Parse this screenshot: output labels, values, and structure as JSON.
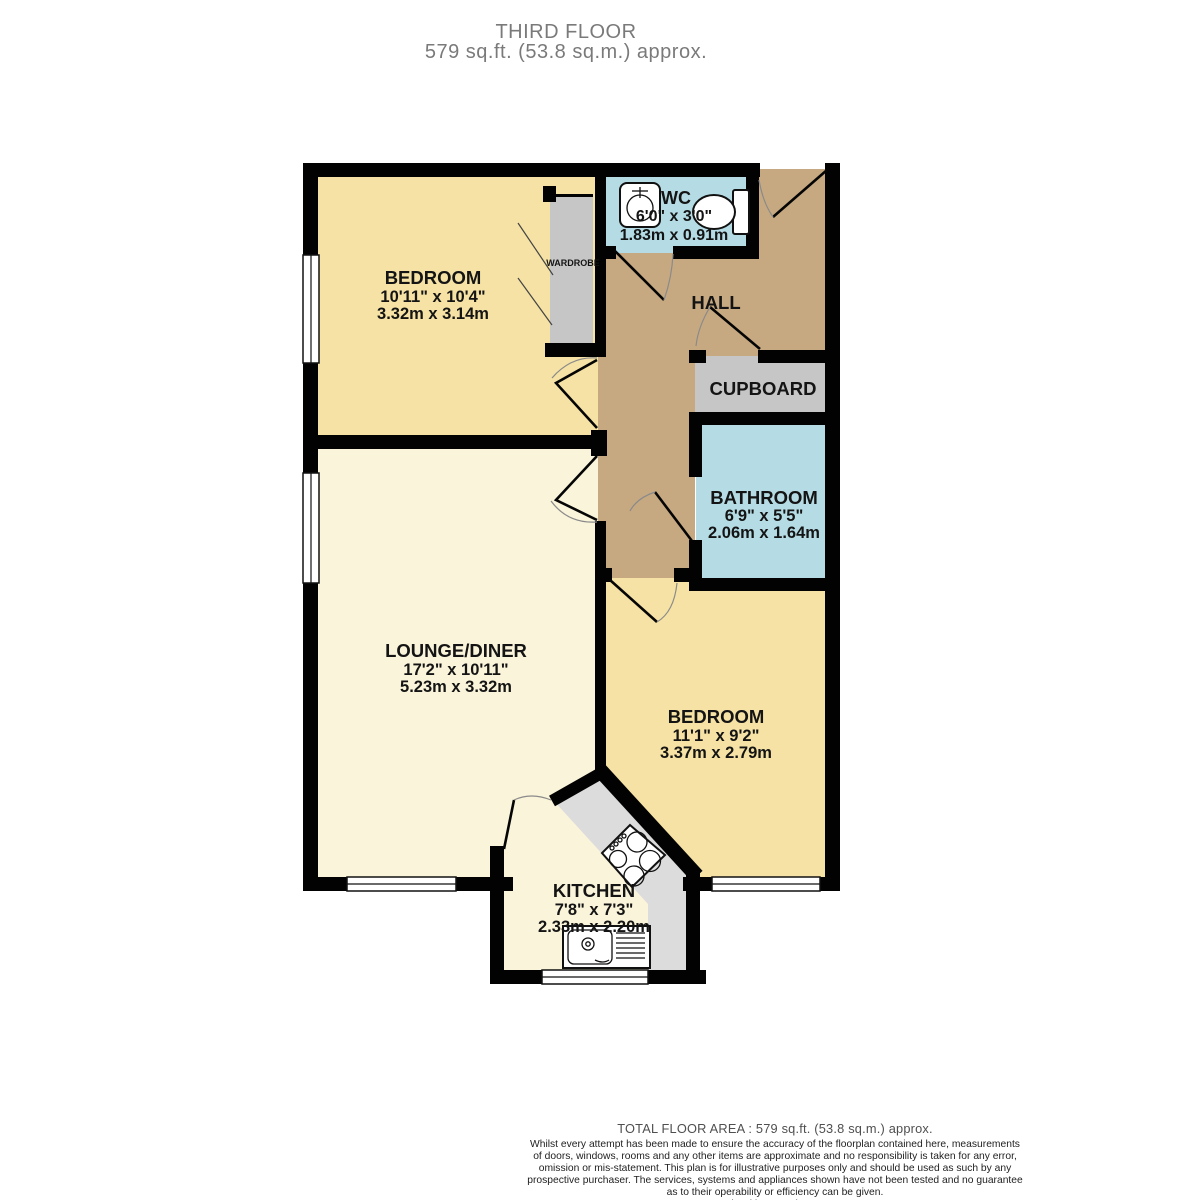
{
  "header": {
    "floor": "THIRD FLOOR",
    "area": "579 sq.ft. (53.8 sq.m.) approx."
  },
  "rooms": {
    "bedroom1": {
      "name": "BEDROOM",
      "imperial": "10'11\" x 10'4\"",
      "metric": "3.32m x 3.14m"
    },
    "wc": {
      "name": "WC",
      "imperial": "6'0\" x 3'0\"",
      "metric": "1.83m x 0.91m"
    },
    "hall": {
      "name": "HALL"
    },
    "cupboard": {
      "name": "CUPBOARD"
    },
    "wardrobe": {
      "name": "WARDROBE"
    },
    "bathroom": {
      "name": "BATHROOM",
      "imperial": "6'9\" x 5'5\"",
      "metric": "2.06m x 1.64m"
    },
    "lounge": {
      "name": "LOUNGE/DINER",
      "imperial": "17'2\" x 10'11\"",
      "metric": "5.23m x 3.32m"
    },
    "bedroom2": {
      "name": "BEDROOM",
      "imperial": "11'1\" x 9'2\"",
      "metric": "3.37m x 2.79m"
    },
    "kitchen": {
      "name": "KITCHEN",
      "imperial": "7'8\" x 7'3\"",
      "metric": "2.33m x 2.20m"
    }
  },
  "colors": {
    "bedroom_fill": "#f5e2a4",
    "lounge_fill": "#faf4da",
    "hall_fill": "#c7a981",
    "wet_room_fill": "#b5dce5",
    "storage_fill": "#c6c6c6",
    "counter_fill": "#dcdcdc",
    "wall": "#020202"
  },
  "footer": {
    "total": "TOTAL FLOOR AREA : 579 sq.ft. (53.8 sq.m.) approx.",
    "disclaimer_lines": [
      "Whilst every attempt has been made to ensure the accuracy of the floorplan contained here, measurements",
      "of doors, windows, rooms and any other items are approximate and no responsibility is taken for any error,",
      "omission or mis-statement. This plan is for illustrative purposes only and should be used as such by any",
      "prospective purchaser. The services, systems and appliances shown have not been tested and no guarantee",
      "as to their operability or efficiency can be given.",
      "Made with Metropix ©2025"
    ]
  }
}
